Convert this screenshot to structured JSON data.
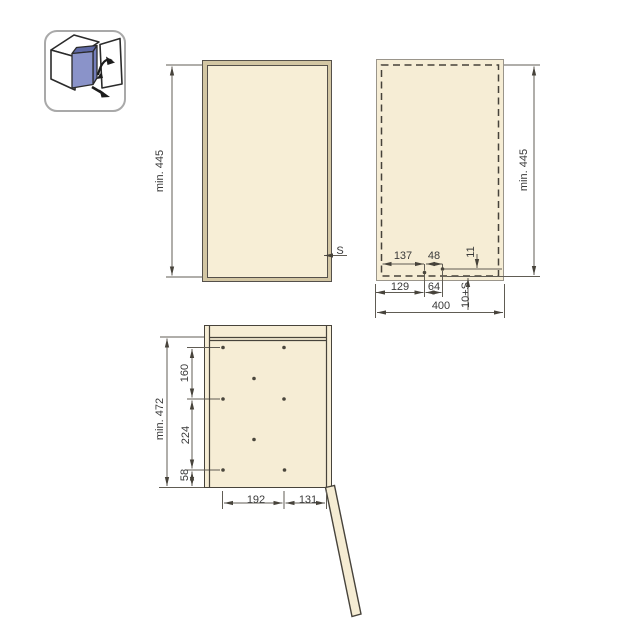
{
  "title": "wall-cabinet pull-out unit installation diagram",
  "colors": {
    "panel_fill": "#f6edd5",
    "frame_fill": "#d3c6a3",
    "outline_dark": "#47433b",
    "outline_gray": "#9a958b",
    "dim_line": "#605c54",
    "text": "#3a3a3a",
    "icon_blue_front": "#8a93c9",
    "icon_blue_side": "#747ebb",
    "icon_blue_top": "#5f69a5",
    "icon_border": "#a9a9a9"
  },
  "icon": {
    "name": "pull-out-unit-with-door-icon"
  },
  "front_view": {
    "height": "min. 445",
    "side_thickness": "S"
  },
  "drilling_view": {
    "height": "min. 445",
    "width": "400",
    "top_offset": "137",
    "hole_spacing_top": "48",
    "edge_distance": "11",
    "bottom_offset": "129",
    "hole_spacing_bottom": "64",
    "depth_offset": "10+S"
  },
  "side_view": {
    "height": "min. 472",
    "row_spacing_1": "160",
    "row_spacing_2": "224",
    "row_spacing_3": "58",
    "hole_span": "192",
    "front_distance": "131"
  }
}
